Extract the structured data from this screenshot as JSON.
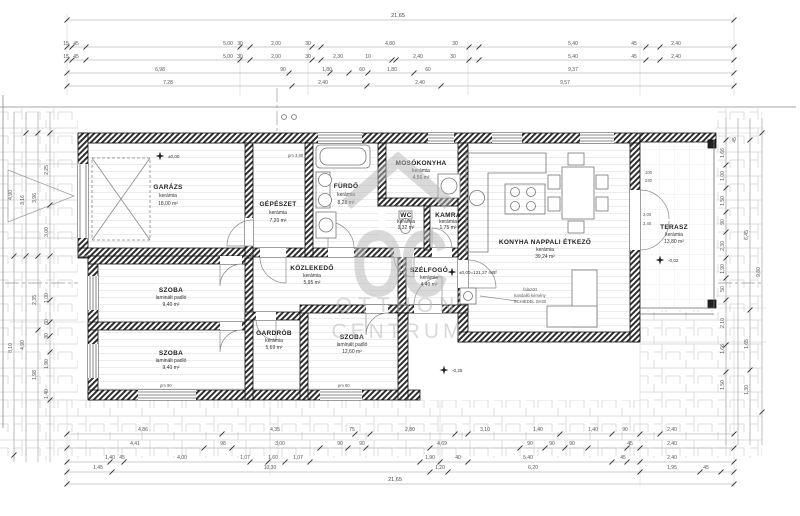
{
  "colors": {
    "wall_hatch": "#2f2f2f",
    "paving_line": "#dedede",
    "dim_line": "#9a9a9a",
    "watermark": "#b5b5b5",
    "floor_line": "#ececec"
  },
  "watermark": {
    "monogram": "OC",
    "word1": "OTTHON",
    "word2": "CENTRUM"
  },
  "rooms": {
    "garaz": {
      "name": "GARÁZS",
      "floor": "kerámia",
      "area": "18,00 m²"
    },
    "gepeszet": {
      "name": "GÉPÉSZET",
      "floor": "kerámia",
      "area": "7,20 m²"
    },
    "furdo": {
      "name": "FÜRDŐ",
      "floor": "kerámia",
      "area": "8,28 m²"
    },
    "mosokonyha": {
      "name": "MOSÓKONYHA",
      "floor": "kerámia",
      "area": "4,56 m²"
    },
    "wc": {
      "name": "WC",
      "floor": "kerámia",
      "area": "1,32 m²"
    },
    "kamra": {
      "name": "KAMRA",
      "floor": "kerámia",
      "area": "1,75 m²"
    },
    "konyha": {
      "name": "KONYHA NAPPALI ÉTKEZŐ",
      "floor": "kerámia",
      "area": "39,24 m²"
    },
    "terasz": {
      "name": "TERASZ",
      "floor": "kerámia",
      "area": "13,80 m²"
    },
    "kozlekedo": {
      "name": "KÖZLEKEDŐ",
      "floor": "kerámia",
      "area": "5,95 m²"
    },
    "szelfogo": {
      "name": "SZÉLFOGÓ",
      "floor": "kerámia",
      "area": "4,40 m²"
    },
    "szoba1": {
      "name": "SZOBA",
      "floor": "laminált padló",
      "area": "9,40 m²"
    },
    "szoba2": {
      "name": "SZOBA",
      "floor": "laminált padló",
      "area": "9,40 m²"
    },
    "gardrob": {
      "name": "GARDRÓB",
      "floor": "kerámia",
      "area": "5,69 m²"
    },
    "szoba3": {
      "name": "SZOBA",
      "floor": "laminált padló",
      "area": "12,60 m²"
    }
  },
  "levels": {
    "garage": "±0,00",
    "main": "±0,00=121,27 mBf",
    "terasz": "-0,02",
    "entry": "-0,25"
  },
  "notes": {
    "chimney1": "falazott",
    "chimney2": "kandalló kémény",
    "chimney3": "SCHIEDEL SH30",
    "pm380": "pm 3,80",
    "pm90": "pm 90",
    "w100": "100",
    "w240": "240",
    "w200": "2,00",
    "w240b": "2,40"
  },
  "dims": {
    "total": "21,65",
    "top_b": [
      "15",
      "45",
      "5,00",
      "30",
      "2,00",
      "30",
      "4,80",
      "30",
      "5,40",
      "45",
      "2,40"
    ],
    "top_c": [
      "15",
      "45",
      "5,00",
      "30",
      "2,00",
      "30",
      "2,30",
      "10",
      "2,40",
      "30",
      "5,40",
      "45",
      "2,40"
    ],
    "top_d": [
      "6,98",
      "90",
      "1,80",
      "60",
      "1,80",
      "60",
      "9,37"
    ],
    "top_e": [
      "7,28",
      "2,40",
      "2,40",
      "9,57"
    ],
    "bottom_a": [
      "4,86",
      "4,35",
      "75",
      "2,80",
      "3,10",
      "1,40",
      "1,40",
      "90",
      "2,40"
    ],
    "bottom_b": [
      "4,41",
      "98",
      "3,00",
      "90",
      "90",
      "4,69",
      "90",
      "90",
      "90",
      "45",
      "2,40"
    ],
    "bottom_c": [
      "1,40",
      "45",
      "4,00",
      "1,07",
      "1,60",
      "1,07",
      "1,90",
      "40",
      "5,40",
      "45",
      "2,40"
    ],
    "bottom_d": [
      "1,45",
      "10,30",
      "1,20",
      "6,20",
      "1,95",
      "45"
    ],
    "bottom_total": "21,65",
    "left": [
      "4,90",
      "8,10",
      "3,16",
      "4,90",
      "3,96",
      "2,35",
      "1,98",
      "2,25",
      "3,00",
      "1,00",
      "60",
      "30",
      "1,90",
      "1,40"
    ],
    "right": [
      "1,66",
      "1,00",
      "1,50",
      "90",
      "2,30",
      "1,90",
      "50",
      "2,10",
      "1,66",
      "45",
      "1,50",
      "6,45",
      "1,65",
      "1,30",
      "9,80"
    ]
  }
}
